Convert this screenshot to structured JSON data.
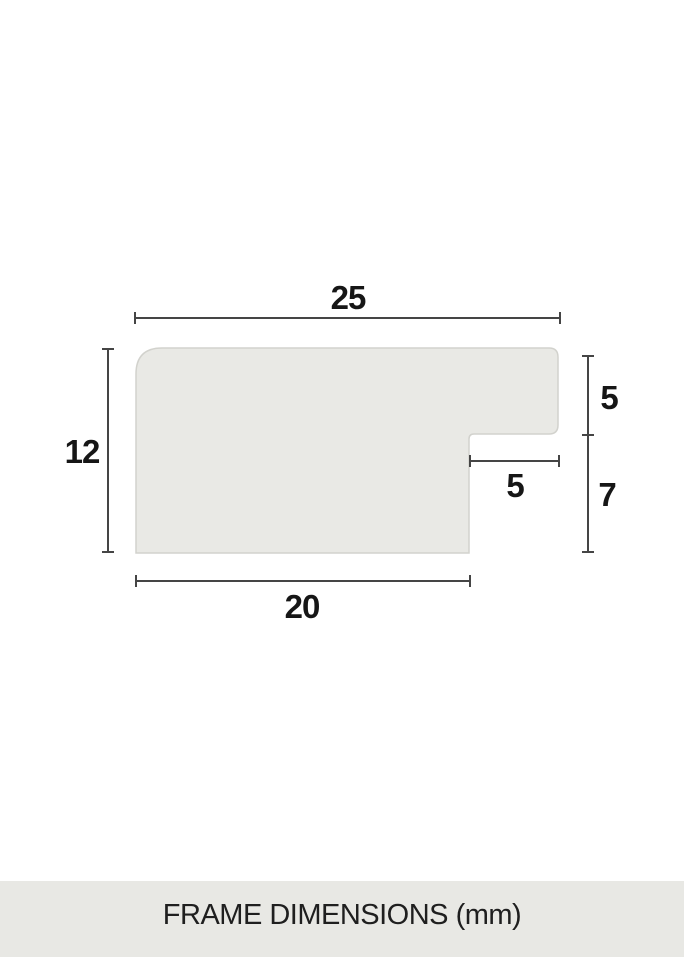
{
  "diagram": {
    "title_implied": "frame moulding profile cross-section",
    "labels": {
      "top_width": "25",
      "left_height": "12",
      "right_upper": "5",
      "right_lower": "7",
      "inner_width": "5",
      "bottom_width": "20"
    },
    "colors": {
      "shape_fill": "#e9e9e5",
      "shape_stroke": "#d2d2cd",
      "dimension_line": "#454545",
      "label_text": "#161616"
    }
  },
  "footer": {
    "caption": "FRAME DIMENSIONS (mm)",
    "background": "#e8e8e4",
    "text_color": "#1f1f1f"
  }
}
